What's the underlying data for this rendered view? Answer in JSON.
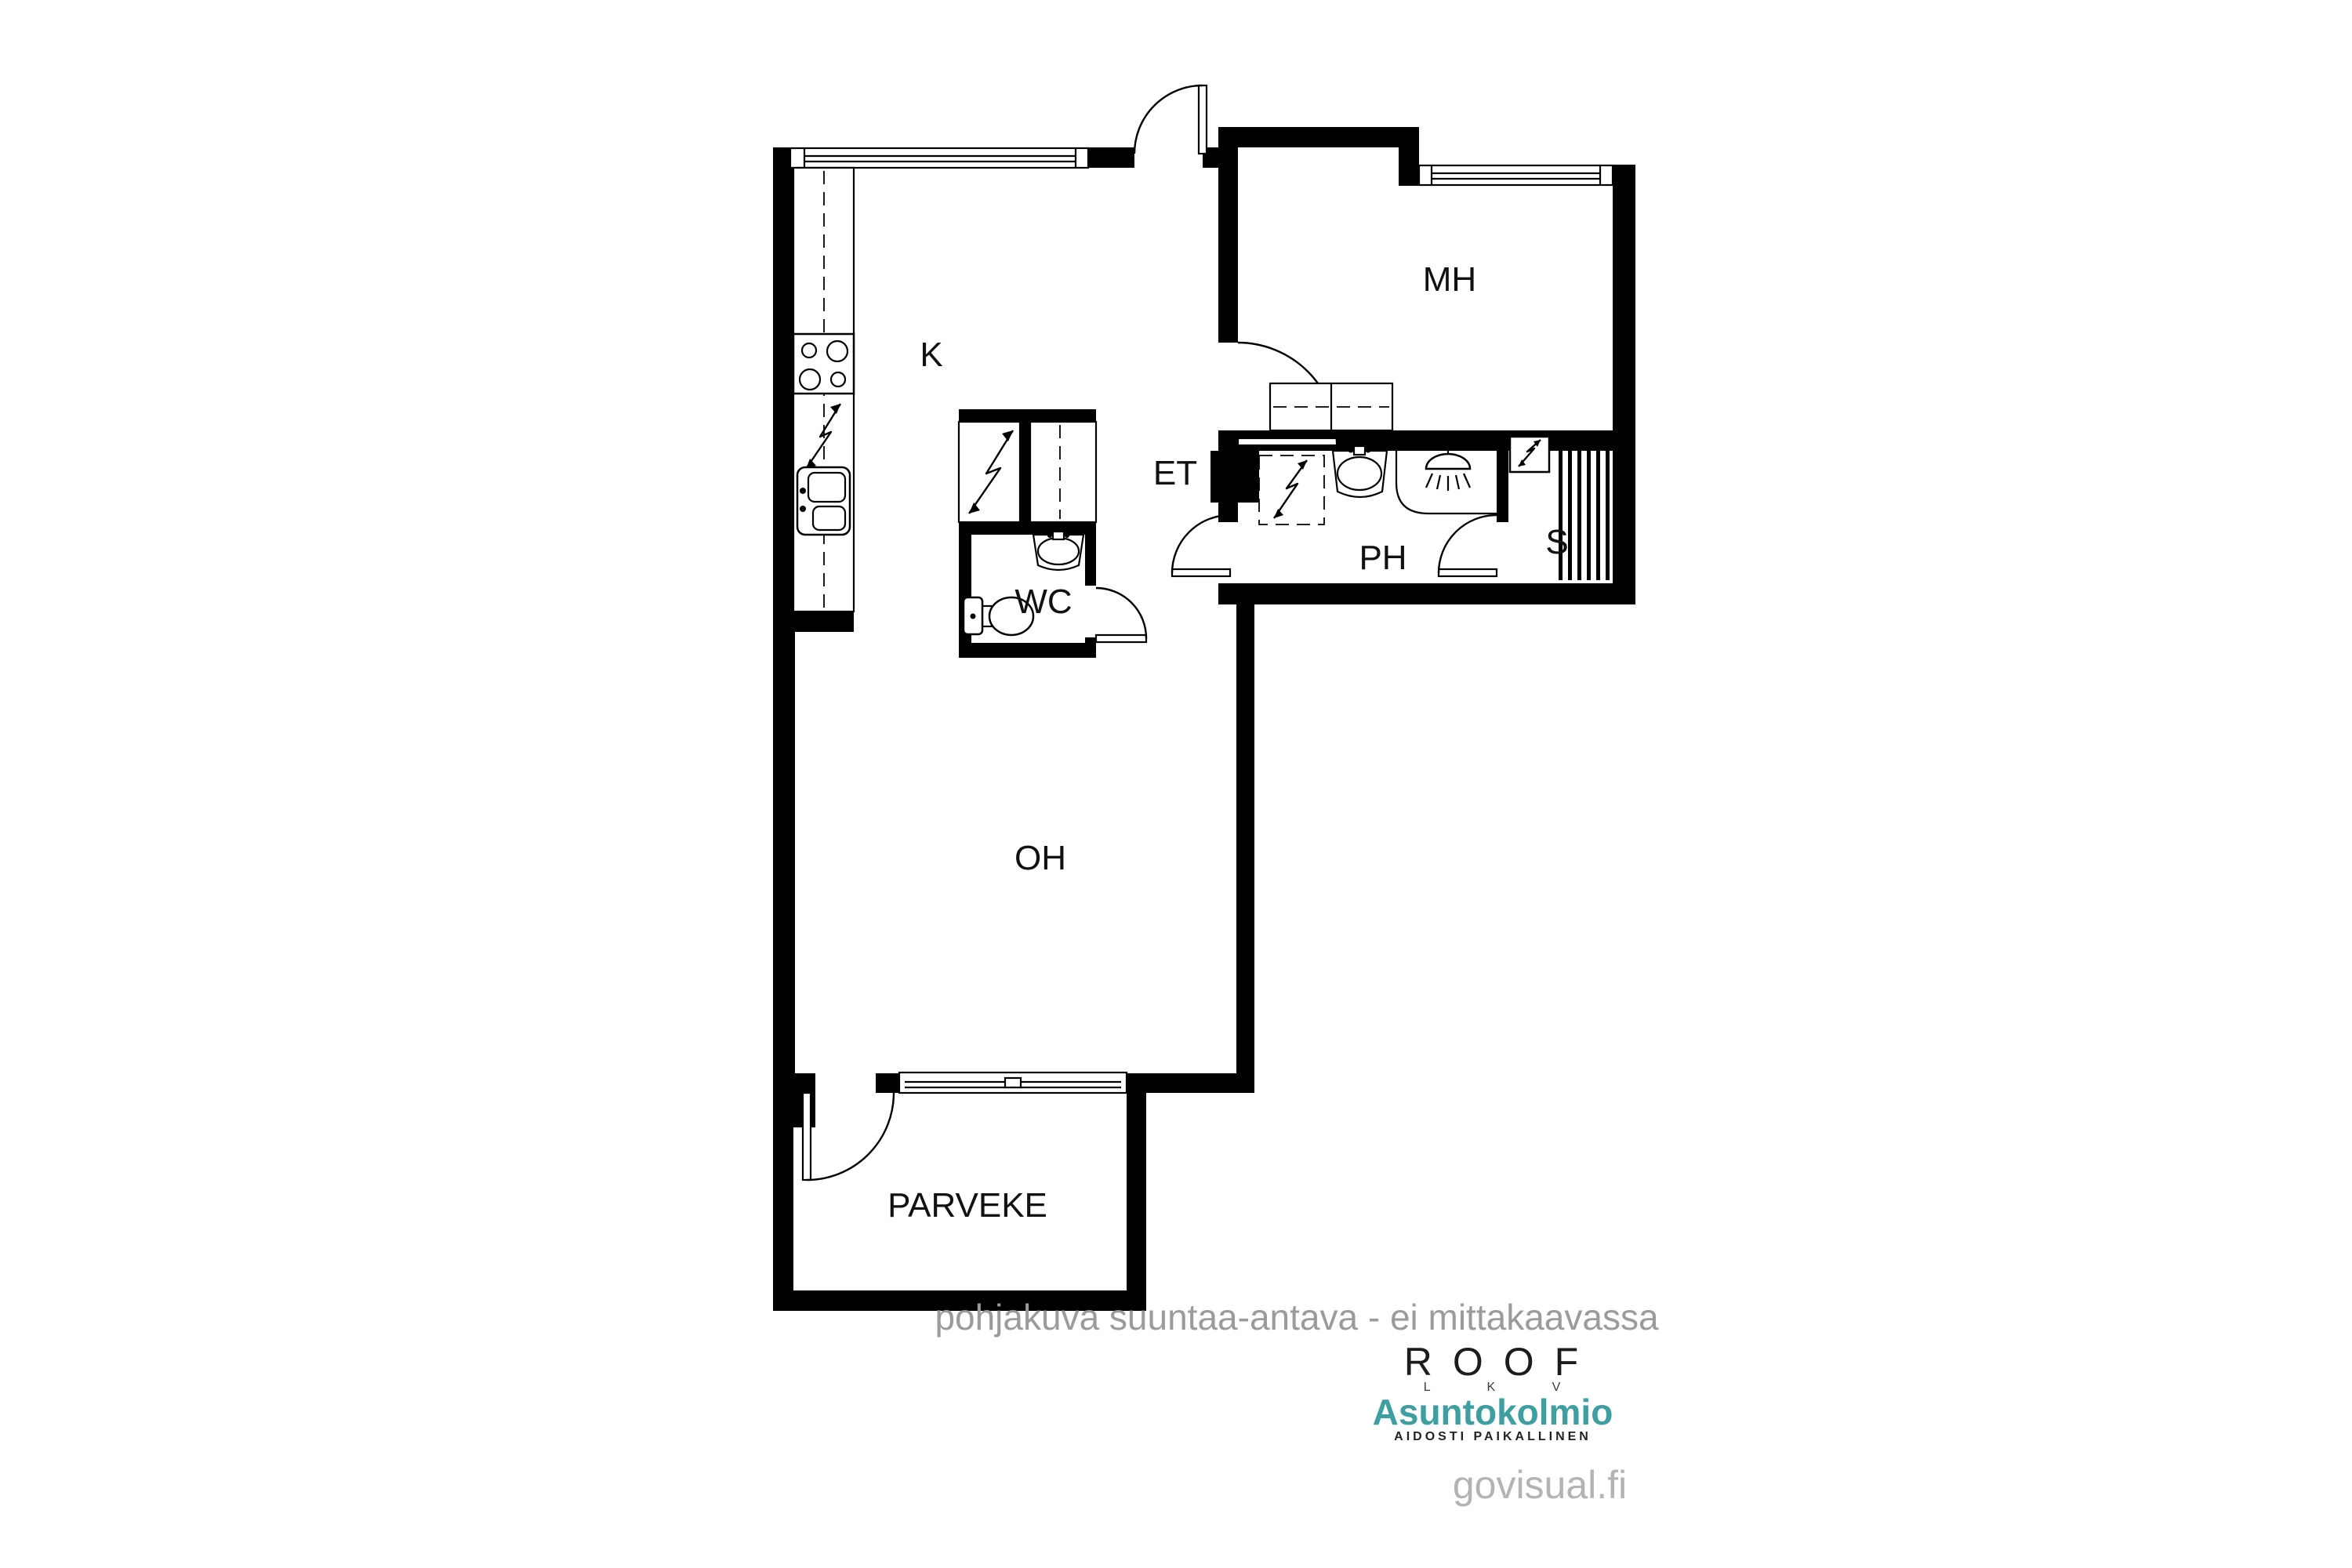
{
  "page": {
    "type": "architectural-floor-plan",
    "background": "#ffffff"
  },
  "floorplan": {
    "rooms": [
      {
        "code": "K",
        "name": "kitchen"
      },
      {
        "code": "MH",
        "name": "bedroom"
      },
      {
        "code": "ET",
        "name": "entry-hall"
      },
      {
        "code": "PH",
        "name": "bathroom"
      },
      {
        "code": "S",
        "name": "sauna"
      },
      {
        "code": "WC",
        "name": "toilet"
      },
      {
        "code": "OH",
        "name": "living-room"
      },
      {
        "code": "PARVEKE",
        "name": "balcony"
      }
    ],
    "icons": [
      {
        "name": "stove-icon",
        "shape": "square-with-4-burners"
      },
      {
        "name": "kitchen-sink-icon",
        "shape": "double-basin"
      },
      {
        "name": "electrical-appliance-icon",
        "shape": "lightning-bolt"
      },
      {
        "name": "washing-machine-icon",
        "shape": "dashed-square-lightning"
      },
      {
        "name": "shower-icon",
        "shape": "shower-head-rays"
      },
      {
        "name": "sauna-heater-icon",
        "shape": "square-lightning"
      },
      {
        "name": "sauna-benches-icon",
        "shape": "vertical-slats"
      },
      {
        "name": "toilet-icon",
        "shape": "tank-and-bowl"
      },
      {
        "name": "washbasin-icon",
        "shape": "trapezoid-oval"
      },
      {
        "name": "wardrobe-icon",
        "shape": "rect-dashed-front"
      }
    ]
  },
  "footer": {
    "disclaimer": "pohjakuva suuntaa-antava - ei mittakaavassa",
    "roof": {
      "title": "ROOF",
      "subtitle": "L K V"
    },
    "asuntokolmio": {
      "title": "Asuntokolmio",
      "tagline": "AIDOSTI PAIKALLINEN",
      "color": "#3f9fa0"
    },
    "watermark": "govisual.fi"
  },
  "colors": {
    "walls": "#000000",
    "labels": "#111111",
    "disclaimer_gray": "#9b9b9b",
    "watermark_gray": "#b3b3b3",
    "brand_teal": "#3f9fa0"
  }
}
